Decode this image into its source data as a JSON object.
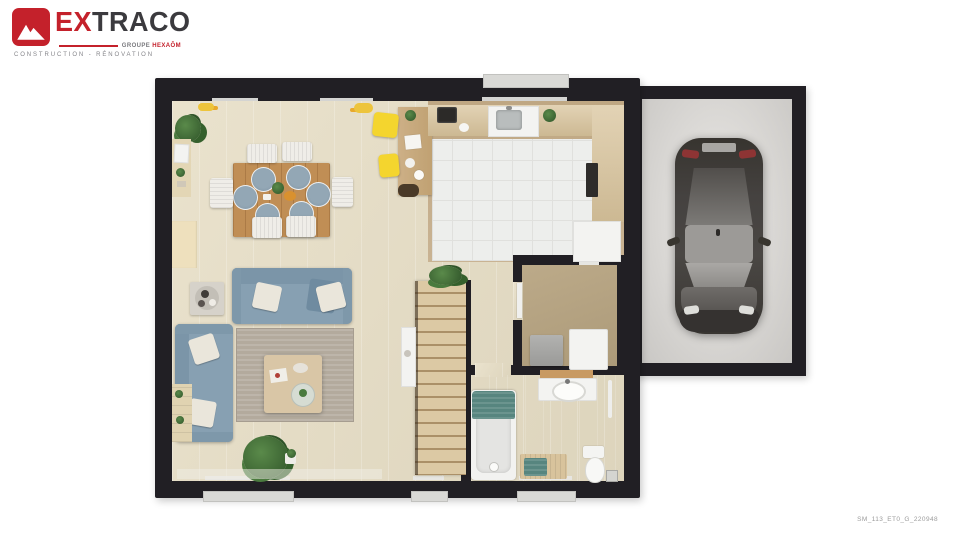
{
  "logo": {
    "brand_ex": "EX",
    "brand_rest": "TRACO",
    "group": "GROUPE",
    "group_name": "HEXAÔM",
    "tagline": "CONSTRUCTION - RÉNOVATION"
  },
  "footer": {
    "reference": "SM_113_ET0_G_220948"
  },
  "plan": {
    "type": "floor-plan-render-top-view",
    "rooms": [
      "dining-area",
      "living-room",
      "kitchen",
      "hallway",
      "utility-room",
      "bathroom",
      "staircase",
      "garage"
    ],
    "furniture": [
      "dining-table",
      "dining-chairs-x6",
      "desk",
      "yellow-stools-x2",
      "kitchen-counters",
      "sink",
      "oven",
      "fridge",
      "sofa-x2",
      "coffee-table",
      "rug",
      "side-table",
      "washing-machine",
      "dryer",
      "bathtub",
      "vanity-sink",
      "toilet",
      "bench",
      "car",
      "plants",
      "windows"
    ]
  },
  "colors": {
    "logo_red": "#c4212b",
    "logo_dark": "#3b3a3e",
    "wall": "#211f24",
    "wood_floor": "#e6ddc4",
    "kitchen_floor": "#c9b393",
    "tile_floor": "#edeeec",
    "utility_floor": "#b7a483",
    "bathroom_floor": "#cbb795",
    "garage_floor": "#d7d5d2",
    "sofa_blue": "#87a0b2",
    "rug_taupe": "#b3aa9d",
    "table_wood": "#c08e55",
    "stairs_wood": "#dcc9a4",
    "accent_yellow": "#f4d52e",
    "accent_teal": "#57857f",
    "car_body": "#3d3a37"
  }
}
